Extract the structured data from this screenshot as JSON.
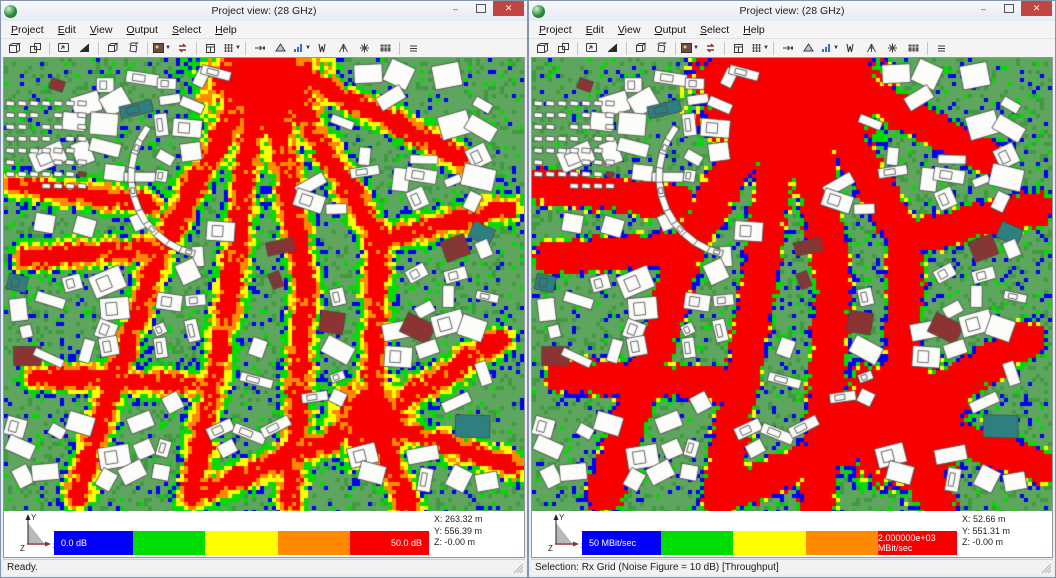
{
  "menu": [
    "Project",
    "Edit",
    "View",
    "Output",
    "Select",
    "Help"
  ],
  "chrome": {
    "minimize": "–",
    "maximize": "",
    "close": "✕"
  },
  "toolbar": {
    "groups": [
      [
        "new-view",
        "duplicate-view"
      ],
      [
        "screenshot",
        "display-fill"
      ],
      [
        "view-3d",
        "rotate-3d"
      ],
      [
        "image-settings",
        "redraw"
      ],
      [
        "database",
        "grid-display"
      ],
      [
        "tx-arrow",
        "rx-plane",
        "result-bars",
        "antenna-pattern",
        "antenna-site",
        "compute-rays",
        "data-table"
      ],
      [
        "list"
      ]
    ]
  },
  "map_colors": {
    "terrain": "#5ea55e",
    "terrain_speckle": "#3f9b3f",
    "building": "#fcfcfa",
    "building_outline": "#4a4a4a",
    "building_accent": "#8c3434",
    "building_teal": "#2e8080"
  },
  "windows": [
    {
      "title": "Project view: (28 GHz)",
      "legend": {
        "colors": [
          "#0000f8",
          "#00dc00",
          "#ffff00",
          "#ff8a00",
          "#f80000"
        ],
        "min_label": "0.0 dB",
        "max_label": "50.0 dB"
      },
      "coords": {
        "x": "X: 263.32 m",
        "y": "Y: 556.39 m",
        "z": "Z: -0.00 m"
      },
      "axis": {
        "x": "x",
        "y": "Y",
        "z": "Z"
      },
      "status": "Ready.",
      "result": "path-loss"
    },
    {
      "title": "Project view: (28 GHz)",
      "legend": {
        "colors": [
          "#0000f8",
          "#00dc00",
          "#ffff00",
          "#ff8a00",
          "#f80000"
        ],
        "min_label": "50 MBit/sec",
        "max_label": "2.000000e+03 MBit/sec"
      },
      "coords": {
        "x": "X: 52.66 m",
        "y": "Y: 551.31 m",
        "z": "Z: -0.00 m"
      },
      "axis": {
        "x": "x",
        "y": "Y",
        "z": "Z"
      },
      "status": "Selection: Rx Grid (Noise Figure = 10 dB) [Throughput]",
      "result": "throughput"
    }
  ]
}
